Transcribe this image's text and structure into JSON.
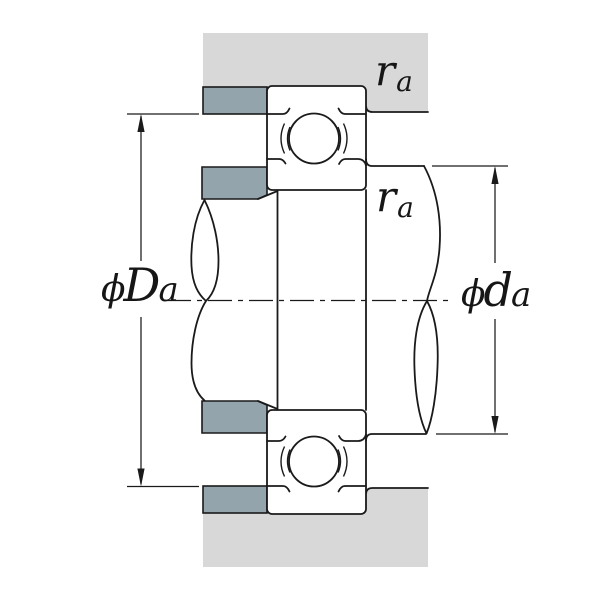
{
  "labels": {
    "housing_abutment_diameter": {
      "phi": "ϕ",
      "letter": "D",
      "sub": "a"
    },
    "shaft_abutment_diameter": {
      "phi": "ϕ",
      "letter": "d",
      "sub": "a"
    },
    "fillet_radius_housing": {
      "letter": "r",
      "sub": "a"
    },
    "fillet_radius_shaft": {
      "letter": "r",
      "sub": "a"
    }
  },
  "colors": {
    "housing": "#d8d8d8",
    "abutment": "#94a4ac",
    "line": "#1a1a1a",
    "background": "#ffffff"
  }
}
